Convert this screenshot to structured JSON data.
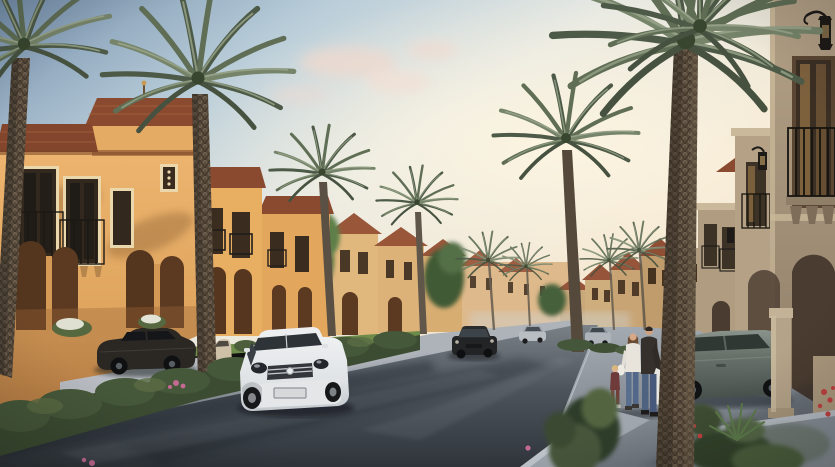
{
  "meta": {
    "title": "Villa community street — sunset architectural render",
    "width": 835,
    "height": 467
  },
  "scene": {
    "description": "Golden-hour street view inside a Mediterranean-style villa compound: sunlit ochre two-storey villas with terracotta roofs on the left, shaded tan villas with wall lanterns and an arched colonnade on the right, date palms lining both sidewalks, cars on the street and a family walking on the right sidewalk.",
    "objects": {
      "sky": "Hazy sky, steel blue upper-left fading to warm cream at the centre glow",
      "left_villas": "Sunlit ochre stucco villas, terracotta hipped roofs, iron juliet balconies, arched entries",
      "right_villas": "Shaded tan villas with black wall lanterns, juliet balconies and arched colonnade",
      "distant_villas": "Rows of gabled villas receding to the central vanishing point",
      "street": "Dark asphalt street receding to the centre",
      "hedge": "Clipped hedge with pink blossoms along the left sidewalk",
      "white_car": "White sedan driving up the street toward the viewer",
      "parked_dark_car": "Dark sedan parked in a left-side driveway",
      "beige_car": "Beige compact parked by the left villas",
      "distant_dark_car": "Dark sedan approaching in the distance",
      "distant_silver_car": "Silver sedan in the distance",
      "right_silver_car": "Small silver car parked on the right side",
      "right_parked_car": "Grey-green sedan parked beside the right villas",
      "family": "Man in dark jacket, woman in white top and a toddler walking on the right sidewalk",
      "palms": "Tall date palms lining both sides of the street",
      "planters": "Concrete planters with shrubs, yucca and red flowers on the right sidewalk",
      "license_plate": ""
    }
  },
  "colors": {
    "sky_top": "#7590ad",
    "sky_mid": "#b9cdd9",
    "sky_pale": "#e7e9e3",
    "sky_warm": "#f3e6d0",
    "glow": "#fdf5e1",
    "cloud": "#eed9cf",
    "wall_sunlit": "#ecb46e",
    "wall_sunlit_dark": "#c98a4c",
    "wall_distant": "#e0b87e",
    "wall_right": "#b3a086",
    "wall_right_dark": "#8f7e68",
    "roof": "#8a4a2f",
    "roof_distant": "#9a5639",
    "trim": "#e9d6ac",
    "arch_shadow": "#54351e",
    "road_near": "#2f353b",
    "road_far": "#7a8187",
    "sidewalk": "#a8aeb6",
    "sidewalk_dark": "#6f767e",
    "lawn": "#6d8c4a",
    "hedge": "#3c4c32",
    "hedge_light": "#55683f",
    "palm_dark": "#4d5a47",
    "palm_mid": "#5f6e55",
    "palm_light": "#76846a",
    "trunk": "#574a3b",
    "flower_pink": "#c36a93",
    "flower_red": "#c04040",
    "car_white": "#eef0f1",
    "car_dark": "#2b2723",
    "car_green": "#69736c",
    "car_beige": "#cfc0a8",
    "car_silver": "#b9bec2",
    "lantern": "#1d1a17"
  }
}
